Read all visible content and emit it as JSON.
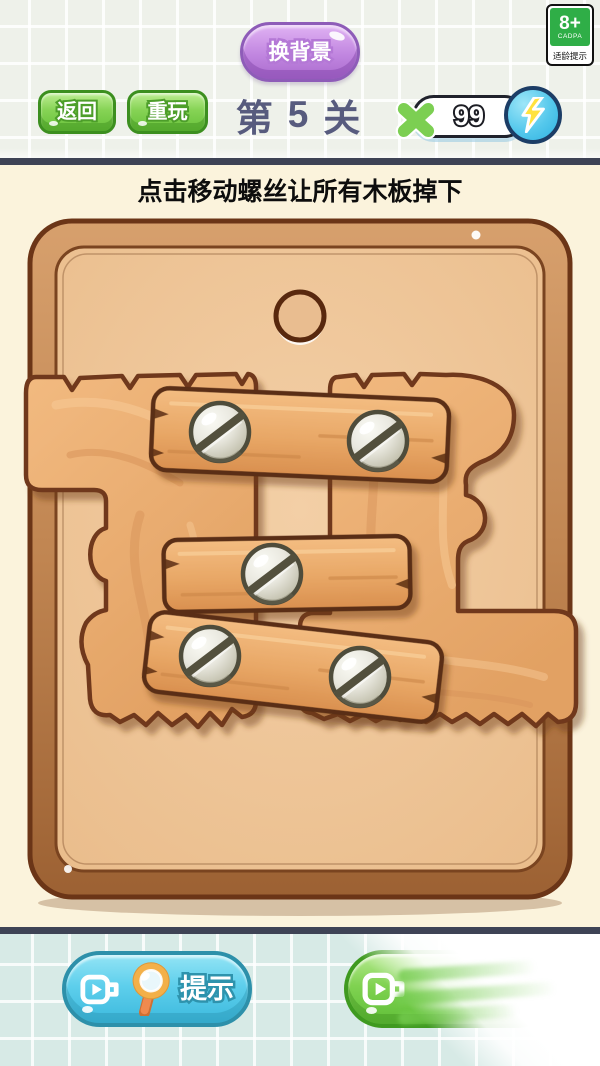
{
  "top_bar": {
    "change_background_label": "换背景",
    "back_label": "返回",
    "replay_label": "重玩",
    "level": {
      "prefix": "第",
      "number": "5",
      "suffix": "关"
    },
    "energy": {
      "count": "99",
      "multiply_icon": "multiply-icon",
      "badge_icon": "lightning-icon"
    }
  },
  "age_badge": {
    "rating": "8+",
    "authority": "CADPA",
    "label": "适龄提示"
  },
  "instruction": "点击移动螺丝让所有木板掉下",
  "board": {
    "hole_count": 1,
    "plank_count": 3,
    "screw_count": 5
  },
  "bottom_bar": {
    "hint_label": "提示",
    "hint_icons": [
      "video-icon",
      "magnifier-icon"
    ],
    "watch_button_icon": "video-icon"
  },
  "colors": {
    "divider": "#3e4355",
    "cream_bg": "#fbf3dc",
    "top_grid_bg": "#eef1ea",
    "bottom_grid_bg": "#d7eae6",
    "board_frame": "#c08551",
    "board_panel": "#f0c89c",
    "big_wood": "#ecaf76",
    "plank": "#e7a664",
    "green_button": "#7ed14f",
    "blue_button": "#59cdec",
    "purple_button": "#bd7edd",
    "energy_blue": "#4cc2e9",
    "lightning_yellow": "#ffe23f",
    "level_text_color": "#575b7e"
  }
}
